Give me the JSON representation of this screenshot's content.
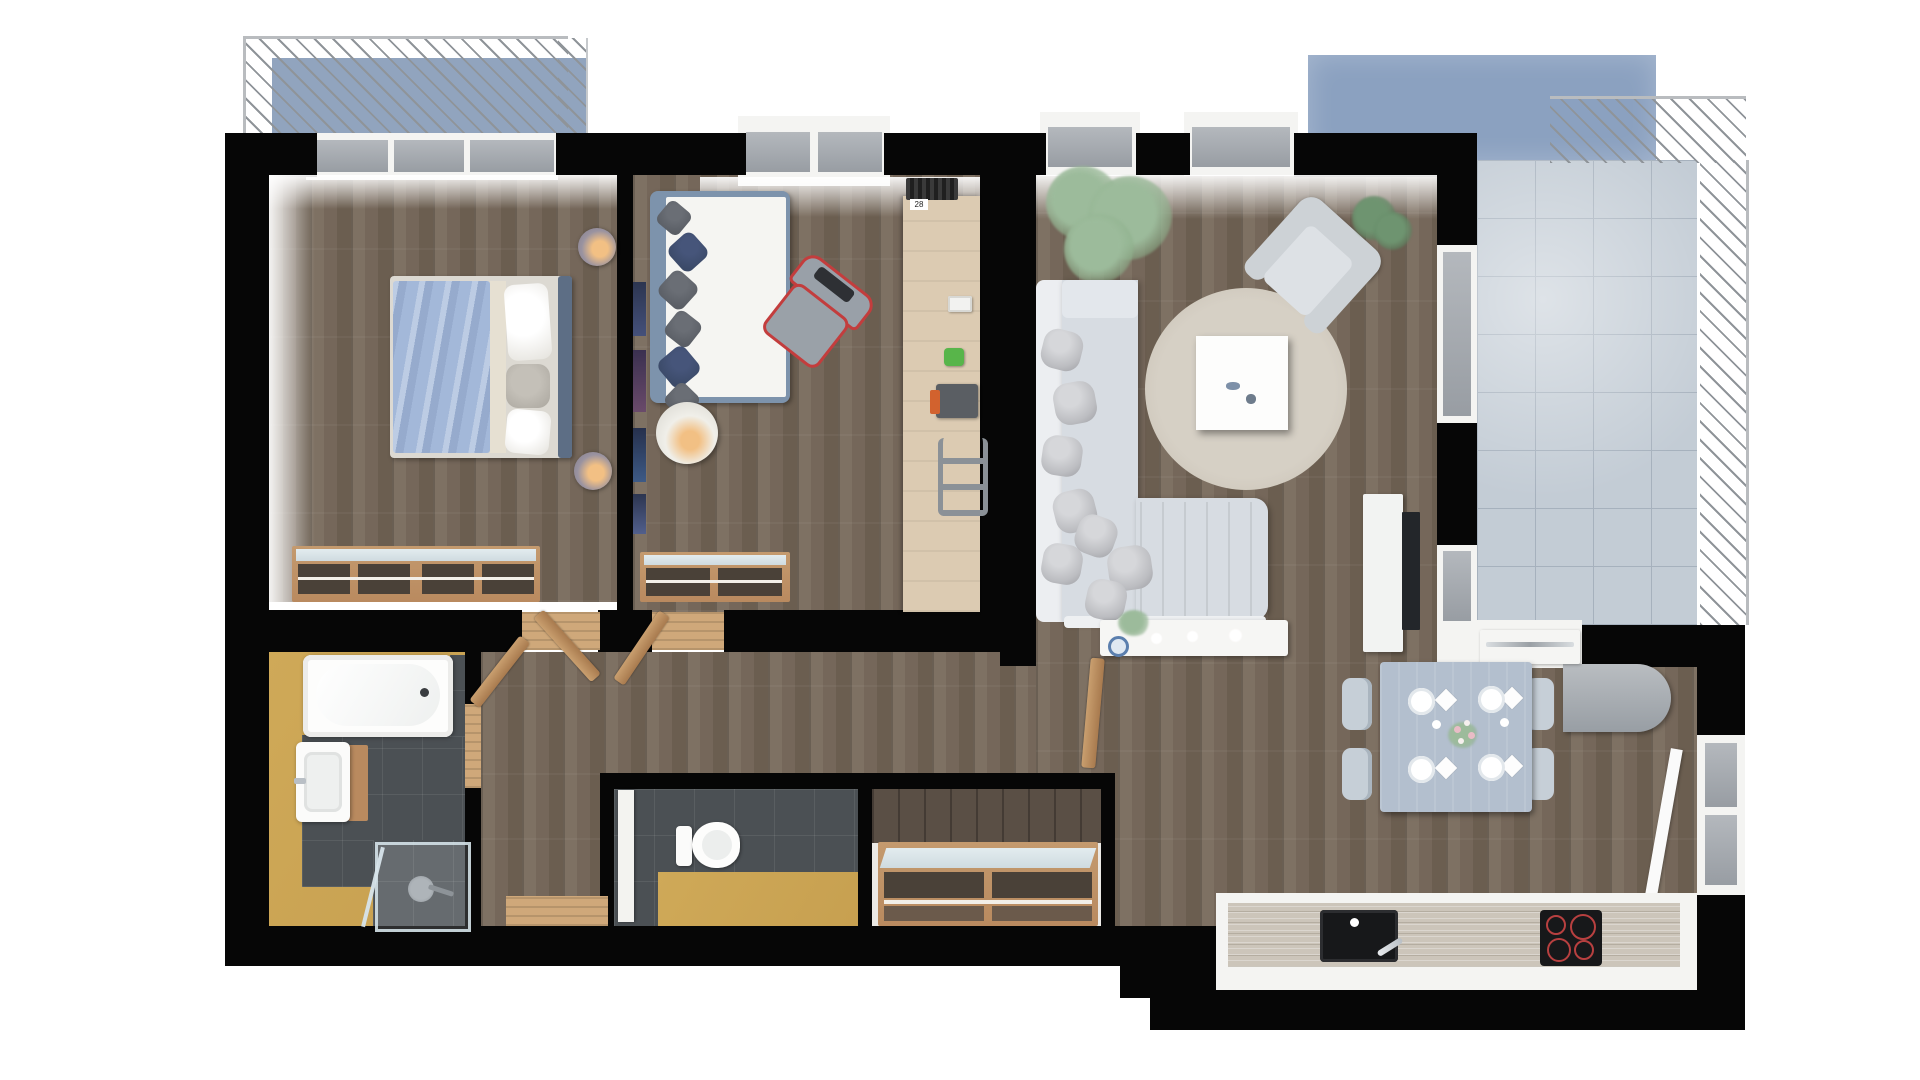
{
  "title": "Apartment 3D Floor Plan",
  "labels": {
    "radiator_tag": "28"
  },
  "palette": {
    "wall": "#060606",
    "wood_a": "#75675a",
    "wood_b": "#7e7163",
    "wood_c": "#6b5e50",
    "desk_wood": "#dccbb2",
    "door_wood": "#b98a5f",
    "threshold": "#cfa87a",
    "balcony_floor": "#91a4be",
    "blue_wall": "#8ba1c0",
    "tile": "#c3ccd5",
    "tile_line": "#a6b1bd",
    "bath_floor": "#c7a050",
    "tile_dark": "#4b5054",
    "glass_a": "#b4b8bd",
    "glass_b": "#989da3",
    "sofa": "#d7dce2",
    "sofa_back": "#eceef1",
    "pillow_silver": "#bcbdc1",
    "rug": "#d0c9bd",
    "plant": "#9cbb9b",
    "plant_dark": "#6e9470",
    "duvet": "#a3b8d9",
    "bed_frame": "#5d6e85",
    "daybed_frame": "#7d93ac",
    "pillow_gray": "#5a5e65",
    "pillow_navy": "#3b4a68",
    "chair_red": "#c33d3d",
    "chair_gray": "#99a0a8",
    "counter": "#ccc5ba",
    "appliance": "#17181a",
    "hob_ring": "#b84040",
    "fridge_a": "#b9bdc1",
    "fridge_b": "#989ea4",
    "table": "#b3bfce",
    "chair_dining": "#c6cfd7",
    "lamp_glow": "#f2c084",
    "white_band": "#f4f4f2",
    "console_white": "#f6f6f4"
  },
  "rooms": [
    {
      "id": "bedroom",
      "label": "Bedroom"
    },
    {
      "id": "bedroom2",
      "label": "Bedroom 2"
    },
    {
      "id": "living",
      "label": "Living Room"
    },
    {
      "id": "kitchen",
      "label": "Kitchen / Dining"
    },
    {
      "id": "bathroom",
      "label": "Bathroom"
    },
    {
      "id": "wc",
      "label": "WC"
    },
    {
      "id": "hallway",
      "label": "Hallway"
    },
    {
      "id": "storage",
      "label": "Storage"
    },
    {
      "id": "balcony",
      "label": "Balcony"
    },
    {
      "id": "terrace",
      "label": "Terrace"
    }
  ],
  "furniture": [
    "double-bed",
    "nightstand-lamp",
    "wardrobe-shelf",
    "daybed",
    "floor-lamp",
    "desk",
    "gaming-chair",
    "radiator",
    "sofa-l-shape",
    "round-rug",
    "coffee-table",
    "armchair",
    "potted-plant",
    "tv-console",
    "tv",
    "sideboard-console",
    "dining-table",
    "dining-chair",
    "plates",
    "flower-centerpiece",
    "kitchen-counter",
    "sink",
    "induction-hob",
    "fridge",
    "bathtub",
    "washbasin",
    "shower",
    "toilet",
    "shoe-cabinet",
    "door"
  ]
}
